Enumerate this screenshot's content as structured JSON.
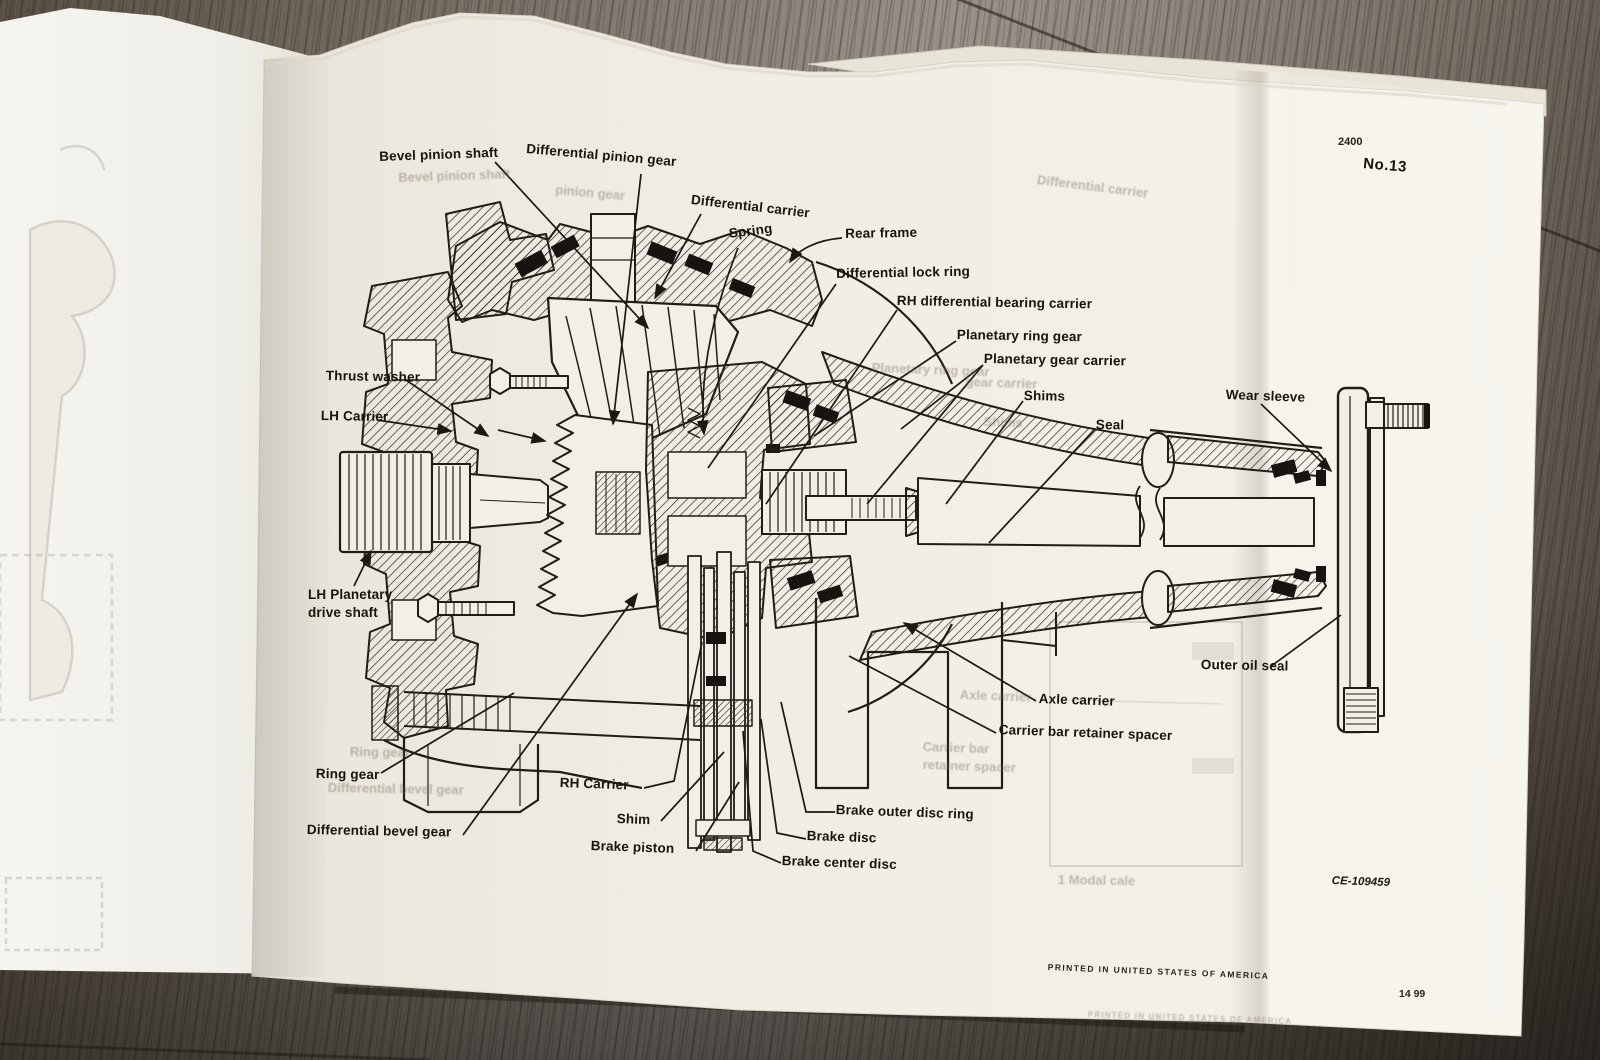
{
  "page": {
    "top_number": "2400",
    "figure_no": "No.13",
    "code": "CE-109459",
    "printed": "PRINTED IN UNITED STATES OF AMERICA",
    "bottom_number": "14 99"
  },
  "labels": [
    "Bevel pinion shaft",
    "Differential pinion gear",
    "Differential carrier",
    "Spring",
    "Rear frame",
    "Differential lock ring",
    "RH differential bearing carrier",
    "Planetary ring gear",
    "Planetary  gear carrier",
    "Shims",
    "Seal",
    "Wear sleeve",
    "Thrust washer",
    "LH Carrier",
    "LH Planetary drive shaft",
    "Ring gear",
    "RH Carrier",
    "Shim",
    "Differential bevel gear",
    "Brake piston",
    "Brake outer disc ring",
    "Brake disc",
    "Brake center disc",
    "Outer oil seal",
    "Axle carrier",
    "Carrier bar retainer spacer"
  ],
  "ghosts": [
    "Bevel pinion shaft",
    "pinion gear",
    "Differential carrier",
    "Planetary ring gear",
    "gear carrier",
    "Shims",
    "Ring gear",
    "Differential bevel gear",
    "Carrier bar",
    "retainer spacer",
    "Axle carrier",
    "1 Modal cale",
    "PRINTED IN UNITED STATES OF AMERICA"
  ],
  "colors": {
    "paper": "#f2efe7",
    "ink": "#211c16",
    "wood_dark": "#49413a",
    "wood_light": "#98918a"
  }
}
